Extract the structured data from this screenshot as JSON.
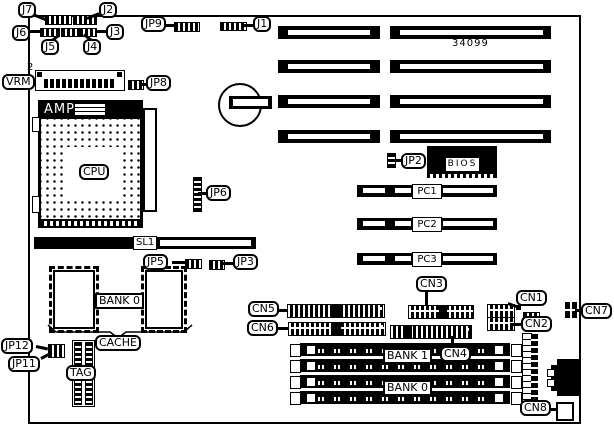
{
  "board": {
    "part_number": "34099"
  },
  "callouts": {
    "j7": "J7",
    "j2": "J2",
    "j6": "J6",
    "j5": "J5",
    "j4": "J4",
    "j3": "J3",
    "j1": "J1",
    "jp9": "JP9",
    "jp8": "JP8",
    "jp6": "JP6",
    "jp5": "JP5",
    "jp3": "JP3",
    "jp2": "JP2",
    "jp12": "JP12",
    "jp11": "JP11",
    "vrm": "VRM",
    "vrm_pin": "2",
    "cn1": "CN1",
    "cn2": "CN2",
    "cn3": "CN3",
    "cn4": "CN4",
    "cn5": "CN5",
    "cn6": "CN6",
    "cn7": "CN7",
    "cn8": "CN8",
    "cache": "CACHE",
    "tag": "TAG"
  },
  "components": {
    "cpu_socket_brand": "AMP",
    "cpu": "CPU",
    "bios": "BIOS",
    "sl1": "SL1",
    "cache_bank": "BANK 0",
    "mem_bank1": "BANK 1",
    "mem_bank0": "BANK 0",
    "pci_slots": [
      "PC1",
      "PC2",
      "PC3"
    ]
  }
}
